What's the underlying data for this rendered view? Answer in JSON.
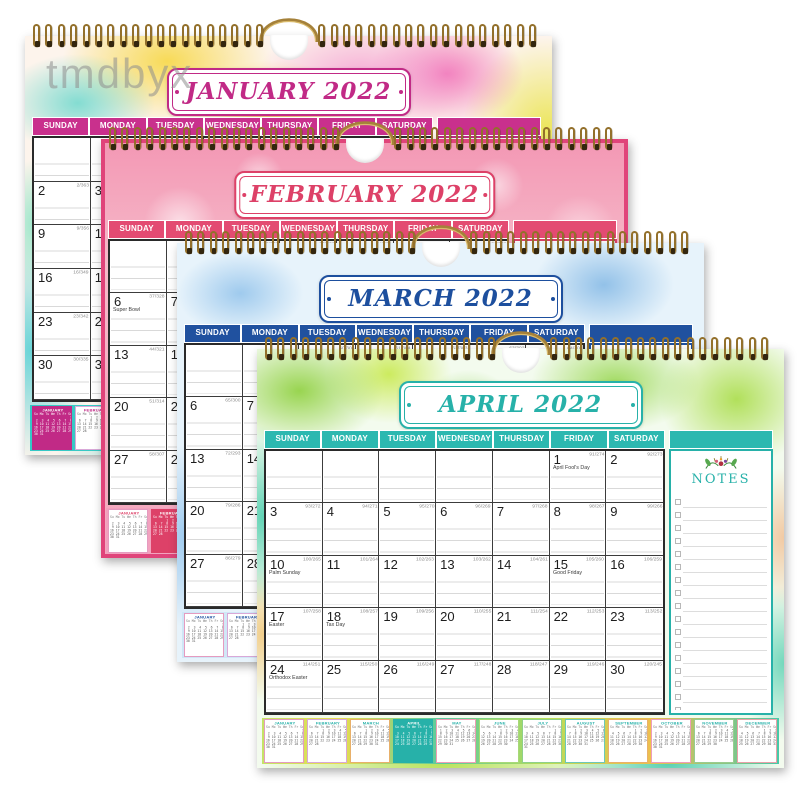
{
  "watermark": "tmdbyx",
  "shared": {
    "day_headers": [
      "SUNDAY",
      "MONDAY",
      "TUESDAY",
      "WEDNESDAY",
      "THURSDAY",
      "FRIDAY",
      "SATURDAY"
    ],
    "weekday_row": "Su Mo Tu We Th Fr Sa",
    "notes_label": "NOTES",
    "year_days": 365
  },
  "mini_months": [
    {
      "name": "JANUARY",
      "start": 6,
      "days": 31
    },
    {
      "name": "FEBRUARY",
      "start": 2,
      "days": 28
    },
    {
      "name": "MARCH",
      "start": 2,
      "days": 31
    },
    {
      "name": "APRIL",
      "start": 5,
      "days": 30
    },
    {
      "name": "MAY",
      "start": 0,
      "days": 31
    },
    {
      "name": "JUNE",
      "start": 3,
      "days": 30
    },
    {
      "name": "JULY",
      "start": 5,
      "days": 31
    },
    {
      "name": "AUGUST",
      "start": 1,
      "days": 31
    },
    {
      "name": "SEPTEMBER",
      "start": 4,
      "days": 30
    },
    {
      "name": "OCTOBER",
      "start": 6,
      "days": 31
    },
    {
      "name": "NOVEMBER",
      "start": 2,
      "days": 30
    },
    {
      "name": "DECEMBER",
      "start": 4,
      "days": 31
    }
  ],
  "mini_border_colors": [
    "#e59bc0",
    "#d9a8d8",
    "#e8b06a",
    "#2bb5ac",
    "#ef9db5",
    "#a8d878",
    "#8fd08a",
    "#6cc8b8",
    "#eab06a",
    "#ef9dbb",
    "#98cc90",
    "#e8a0a8"
  ],
  "calendars": [
    {
      "id": "january",
      "title": "JANUARY 2022",
      "month": 0,
      "start_weekday": 6,
      "num_days": 31,
      "doy_first": 1,
      "accent": "#c12a86",
      "header_bg": "#c9308d",
      "holidays": {}
    },
    {
      "id": "february",
      "title": "FEBRUARY 2022",
      "month": 1,
      "start_weekday": 2,
      "num_days": 28,
      "doy_first": 32,
      "accent": "#dd4168",
      "header_bg": "#e34b72",
      "holidays": {
        "6": "Super Bowl"
      }
    },
    {
      "id": "march",
      "title": "MARCH 2022",
      "month": 2,
      "start_weekday": 2,
      "num_days": 31,
      "doy_first": 60,
      "accent": "#1d4f9e",
      "header_bg": "#20519f",
      "holidays": {}
    },
    {
      "id": "april",
      "title": "APRIL 2022",
      "month": 3,
      "start_weekday": 5,
      "num_days": 30,
      "doy_first": 91,
      "accent": "#27b1a9",
      "header_bg": "#2cb8b0",
      "holidays": {
        "1": "April Fool's Day",
        "10": "Palm Sunday",
        "15": "Good Friday",
        "17": "Easter",
        "18": "Tax Day",
        "24": "Orthodox Easter"
      }
    }
  ]
}
